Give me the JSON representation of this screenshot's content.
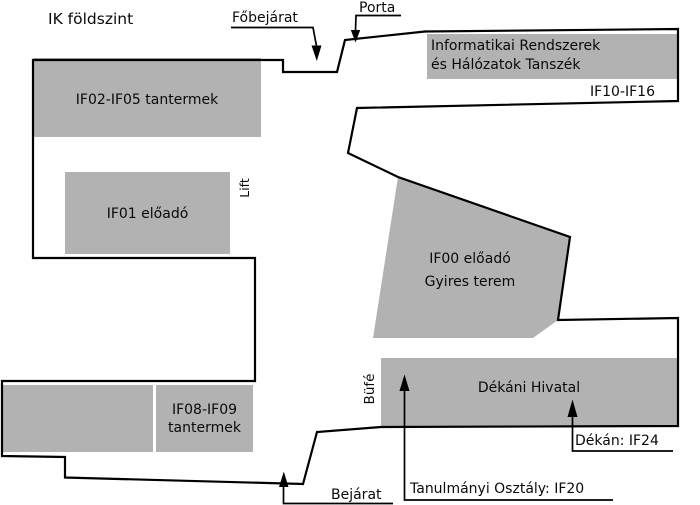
{
  "title": "IK földszint",
  "colors": {
    "room_fill": "#b2b2b2",
    "outline": "#000000",
    "text": "#0a0a0a"
  },
  "rooms": {
    "if02": {
      "label": "IF02-IF05 tantermek"
    },
    "if01": {
      "label": "IF01 előadó"
    },
    "dept": {
      "line1": "Informatikai Rendszerek",
      "line2": "és Hálózatok Tanszék",
      "rooms_label": "IF10-IF16"
    },
    "if00": {
      "line1": "IF00 előadó",
      "line2": "Gyires terem"
    },
    "dekani": {
      "label": "Dékáni Hivatal"
    },
    "if08": {
      "line1": "IF08-IF09",
      "line2": "tantermek"
    }
  },
  "annotations": {
    "fobejarat": "Főbejárat",
    "porta": "Porta",
    "lift": "Lift",
    "bufe": "Büfé",
    "bejarat": "Bejárat",
    "dekan": "Dékán: IF24",
    "tanulmanyi": "Tanulmányi Osztály: IF20"
  }
}
